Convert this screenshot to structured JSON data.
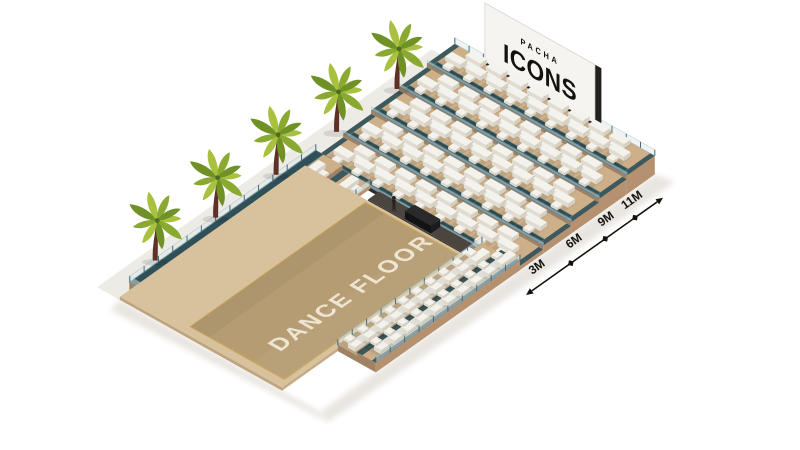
{
  "scene": {
    "background_color": "#ffffff",
    "shadow_color": "#e6e2dd"
  },
  "dance_floor": {
    "label": "DANCE FLOOR",
    "label_color": "#f1e9d7",
    "surface_color": "#b59c72",
    "apron_color": "#d7c29d",
    "trim_color": "#c9a45c"
  },
  "billboard": {
    "brand_top": "PACHA",
    "brand_main": "ICONS",
    "panel_color": "#f6f4f1",
    "edge_color": "#23211f",
    "text_color": "#14110e"
  },
  "stage": {
    "deck_color": "#4a463f",
    "booth_color": "#17171a"
  },
  "person": {
    "count": 1,
    "color": "#26231f"
  },
  "palms": {
    "count": 5,
    "frond_colors": [
      "#a8c240",
      "#8aa930",
      "#6f9126"
    ],
    "trunk_color": "#5e3026",
    "walkway_color": "#edebe6"
  },
  "seating": {
    "sofa_color": "#f4f2ec",
    "sofa_shade_left": "#e1dcd1",
    "sofa_shade_right": "#d6d0c3",
    "platform_color": "#cdb08a",
    "platform_side_color": "#b5916f",
    "platform_step_color": "#9f8164",
    "walkway_color": "#2f5058",
    "glass_color": "#dfeaec",
    "sections": [
      {
        "id": "grandstand",
        "tiers": 5,
        "sofas_per_tier": 17
      },
      {
        "id": "left-terrace",
        "rows": 2,
        "sofas_per_row": 13
      },
      {
        "id": "right-terrace",
        "rows": 2,
        "sofas_per_row": 10
      }
    ]
  },
  "measurements": {
    "labels": [
      "3M",
      "6M",
      "9M",
      "11M"
    ],
    "color": "#16130f"
  }
}
